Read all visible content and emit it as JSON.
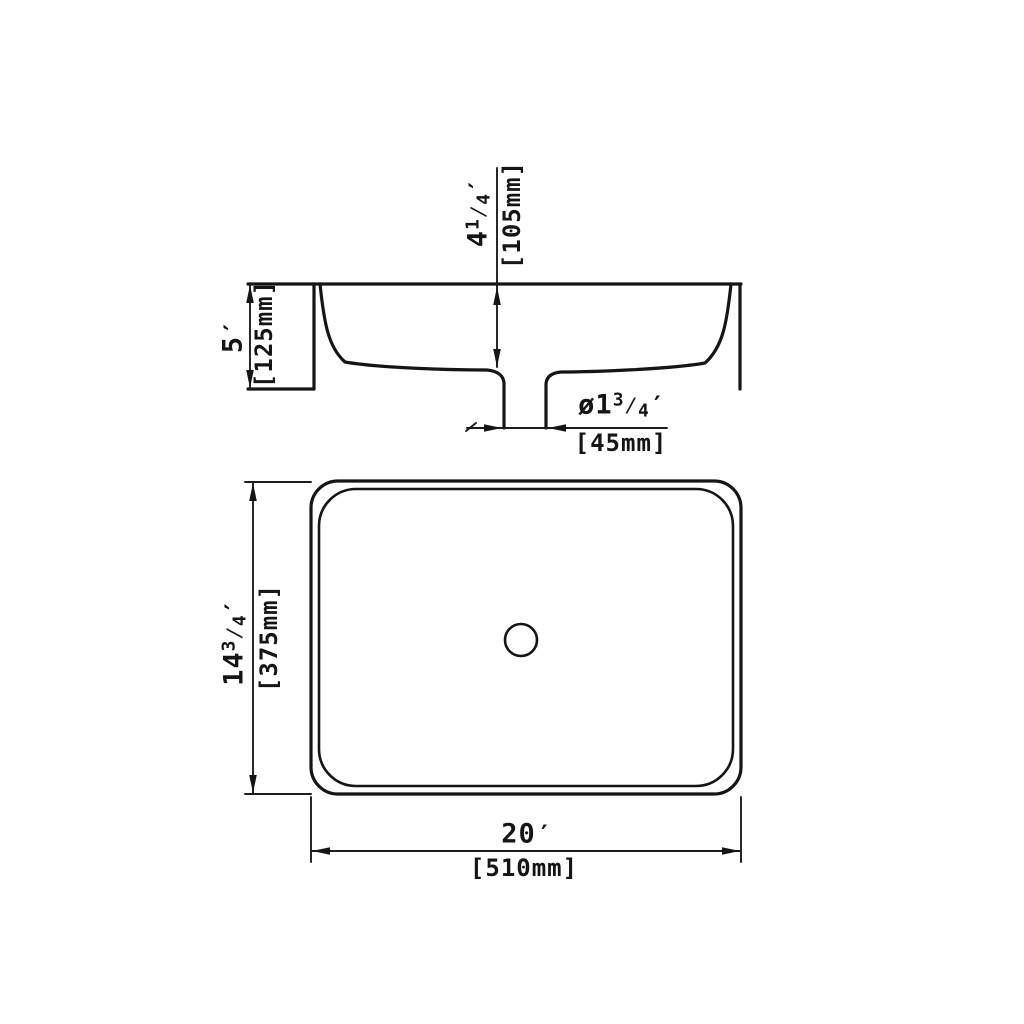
{
  "symbols": {
    "fraction_slash": "⁄",
    "diameter_prefix": "ø",
    "inch_mark": "′"
  },
  "section_view": {
    "basin_depth": {
      "whole": "4",
      "num": "1",
      "den": "4",
      "metric": "[105mm]"
    },
    "overall_height": {
      "whole": "5",
      "metric": "[125mm]"
    },
    "drain_diameter": {
      "whole": "1",
      "num": "3",
      "den": "4",
      "metric": "[45mm]"
    }
  },
  "plan_view": {
    "overall_depth": {
      "whole": "14",
      "num": "3",
      "den": "4",
      "metric": "[375mm]"
    },
    "overall_width": {
      "whole": "20",
      "metric": "[510mm]"
    }
  }
}
